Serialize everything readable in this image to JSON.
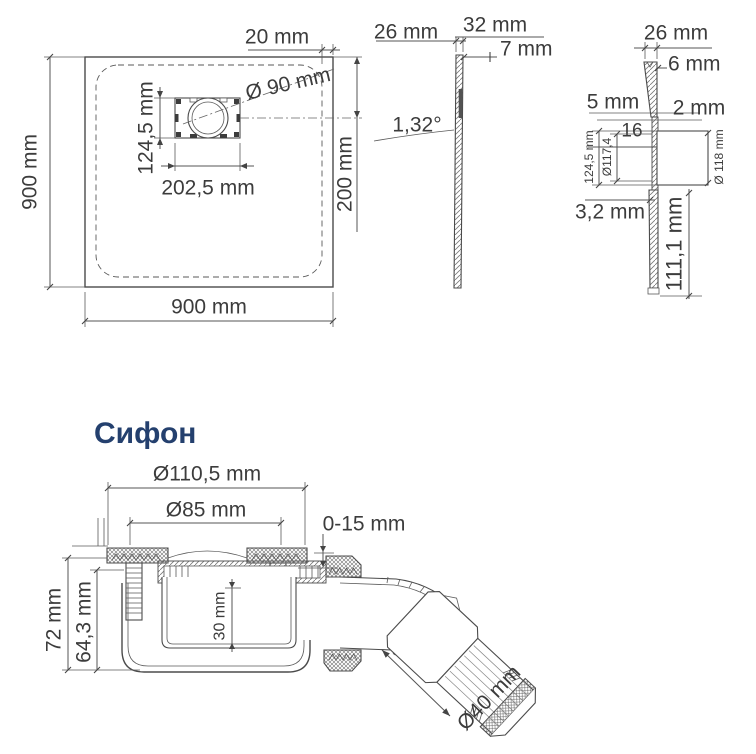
{
  "colors": {
    "line": "#4b4b4b",
    "text": "#3c3c3c",
    "title": "#24406e"
  },
  "plan_view": {
    "side_left": "900 mm",
    "side_bottom": "900 mm",
    "top_offset": "20 mm",
    "drain_diameter": "Ø 90 mm",
    "drain_height": "124,5 mm",
    "drain_width": "202,5 mm",
    "right_offset": "200 mm"
  },
  "side_view": {
    "rim_depth": "26 mm",
    "edge_height": "32 mm",
    "edge_top": "7 mm",
    "slope_angle": "1,32°"
  },
  "detail_view": {
    "rim_depth": "26 mm",
    "edge_top": "6 mm",
    "gap_left": "5 mm",
    "gap_right": "2 mm",
    "step": "16",
    "recess_height": "124,5 mm",
    "recess_diameter": "Ø117,4",
    "hole_diameter": "Ø 118 mm",
    "bottom_thickness": "3,2 mm",
    "total_depth": "111,1 mm"
  },
  "siphon": {
    "heading": "Сифон",
    "flange_diameter": "Ø110,5 mm",
    "grate_diameter": "Ø85 mm",
    "adjust_range": "0-15 mm",
    "total_height": "72 mm",
    "body_height": "64,3 mm",
    "cup_depth": "30 mm",
    "outlet_diameter": "Ø40 mm"
  }
}
